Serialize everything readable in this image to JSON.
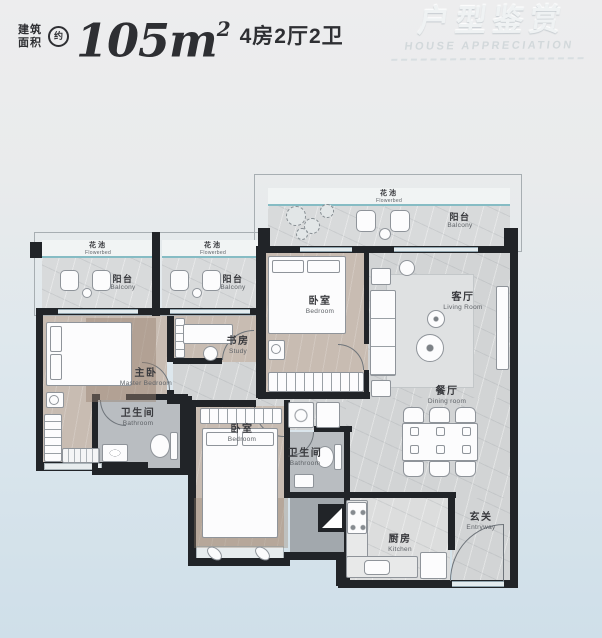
{
  "header": {
    "area_label_line1": "建筑",
    "area_label_line2": "面积",
    "approx": "约",
    "area_value": "105m",
    "area_superscript": "2",
    "spec": "4房2厅2卫"
  },
  "watermark": {
    "title": "户型鉴赏",
    "subtitle": "HOUSE APPRECIATION"
  },
  "rooms": {
    "flowerbed": {
      "zh": "花池",
      "en": "Flowerbed"
    },
    "balcony": {
      "zh": "阳台",
      "en": "Balcony"
    },
    "bedroom": {
      "zh": "卧室",
      "en": "Bedroom"
    },
    "living_room": {
      "zh": "客厅",
      "en": "Living Room"
    },
    "master_bedroom": {
      "zh": "主卧",
      "en": "Master Bedroom"
    },
    "study": {
      "zh": "书房",
      "en": "Study"
    },
    "bathroom": {
      "zh": "卫生间",
      "en": "Bathroom"
    },
    "dining_room": {
      "zh": "餐厅",
      "en": "Dining room"
    },
    "kitchen": {
      "zh": "厨房",
      "en": "Kitchen"
    },
    "entryway": {
      "zh": "玄关",
      "en": "Entryway"
    }
  },
  "colors": {
    "wall": "#212428",
    "bedroom_floor": "#c8bcb2",
    "hall_floor": "#d2d4d5",
    "balcony_floor": "#d8dadb",
    "bathroom_floor": "#b9bdc1",
    "flowerbed_accent": "#86bcc4",
    "background_top": "#ededee",
    "background_bottom": "#cfdfe9",
    "header_text": "#2e2f33"
  }
}
